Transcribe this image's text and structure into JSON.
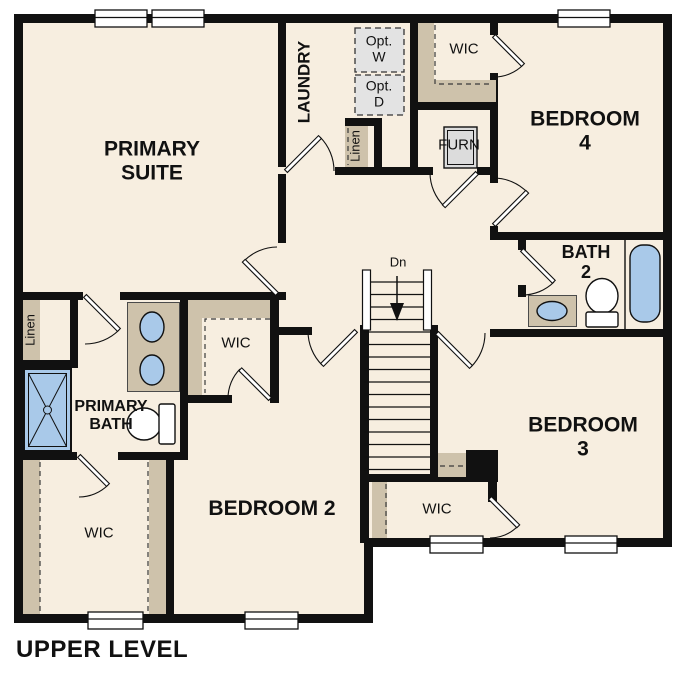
{
  "title": "UPPER LEVEL",
  "colors": {
    "wall": "#111111",
    "floor": "#f7eee0",
    "closet_tan": "#cec2ab",
    "fixture_blue": "#a9c9e9",
    "opt_grey": "#e3e3e3",
    "furn_grey": "#dcdcdc"
  },
  "rooms": {
    "primary_suite": "PRIMARY\nSUITE",
    "laundry": "LAUNDRY",
    "bedroom_4": "BEDROOM 4",
    "bath_2": "BATH\n2",
    "bedroom_3": "BEDROOM 3",
    "bedroom_2": "BEDROOM 2",
    "primary_bath": "PRIMARY\nBATH"
  },
  "closets": {
    "wic_primary": "WIC",
    "wic_upper": "WIC",
    "wic_lower": "WIC",
    "wic_bedroom3": "WIC",
    "linen_hall": "Linen",
    "linen_bath": "Linen"
  },
  "utilities": {
    "furnace": "FURN",
    "opt_washer": "Opt.\nW",
    "opt_dryer": "Opt.\nD"
  },
  "stairs": {
    "direction": "Dn"
  }
}
